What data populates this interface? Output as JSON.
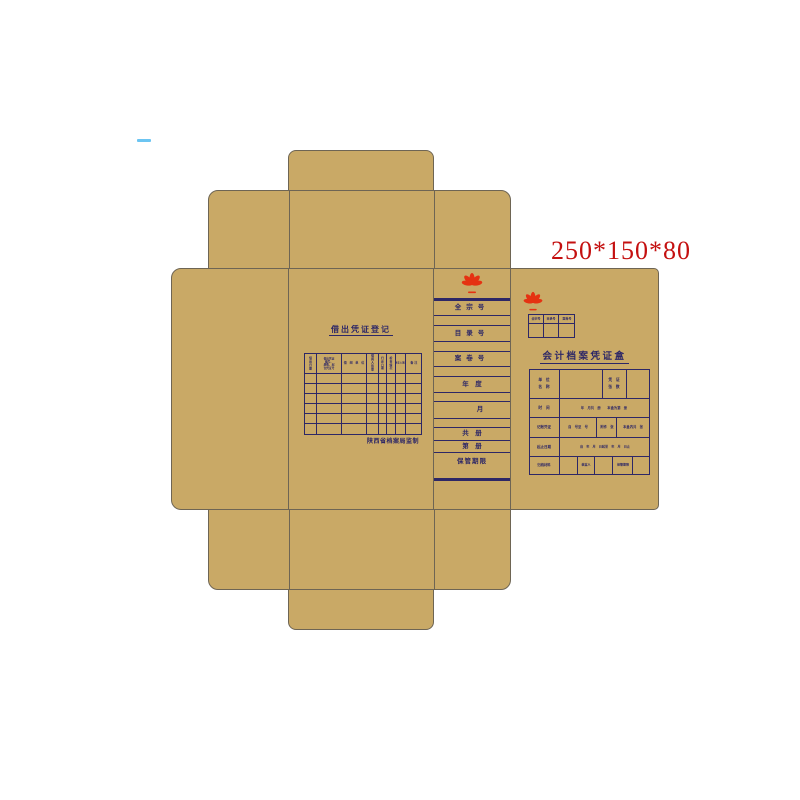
{
  "dimension_label": "250*150*80",
  "colors": {
    "kraft": "#c9a966",
    "line_navy": "#2d2766",
    "die_line": "#6e6554",
    "logo_red": "#e53212",
    "dimension_red": "#c41010"
  },
  "icons": {
    "logo": "flower-logo-icon"
  },
  "left_panel": {
    "title": "借出凭证登记",
    "loan_table": {
      "headers": [
        "借出日期",
        "借出凭证编号、\n册数、起讫凭证号",
        "借 阅 单 位",
        "借阅人\n签章",
        "归还\n日期",
        "检查\n情况",
        "经手人签章",
        "备 注"
      ],
      "blank_rows": 6
    },
    "footer": "陕西省档案局监制"
  },
  "spine": {
    "rows": [
      "全宗号",
      "",
      "目录号",
      "",
      "案卷号",
      "",
      "年　度",
      "",
      "月",
      "",
      "共　册",
      "第　册",
      "保管期限"
    ]
  },
  "right_panel": {
    "ref_table": {
      "headers": [
        "全宗号",
        "目录号",
        "案卷号"
      ]
    },
    "title": "会计档案凭证盒",
    "form": {
      "unit_label": "单　位\n名　称",
      "voucher_label": "凭　证\n张　数",
      "time_label": "时　间",
      "time_text": "年　月共　册　　本盒为第　册",
      "voucher_row_label": "记账凭证",
      "voucher_c1": "自　号至　号",
      "voucher_c2": "附件　张",
      "voucher_c3": "本盒内共　张",
      "date_label": "起止日期",
      "date_text": "自　年　月　日起至　年　月　日止",
      "archive_label": "归档材料",
      "packer_label": "装盒人",
      "retention_label": "保管期限"
    }
  }
}
